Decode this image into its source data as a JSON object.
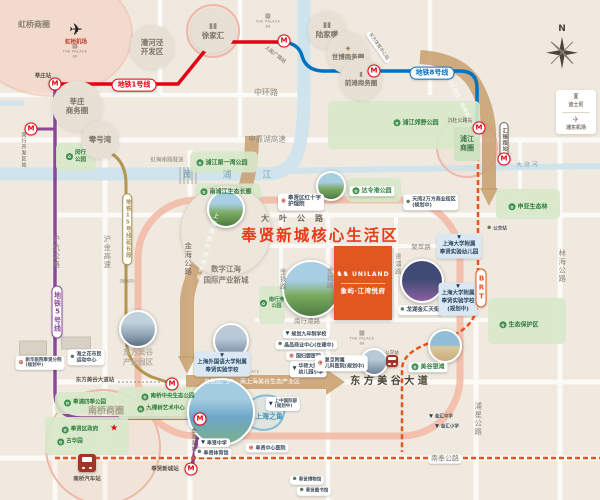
{
  "title": "奉贤新城核心生活区",
  "colors": {
    "background": "#efe9df",
    "road": "#fcfaf7",
    "river": "#cfe4ec",
    "line1_red": "#e60012",
    "line5_purple": "#8c4799",
    "line8_blue": "#0073c0",
    "line15_tan": "#b3954f",
    "brt_orange": "#e8541e",
    "title_red": "#e83a17",
    "band_tan": "#c89f6e",
    "salmon_ring": "#f2b8a3",
    "park_green": "#d7e8c9",
    "brand_orange": "#e2571f"
  },
  "items": [
    {
      "n": "park-area-minhang-park",
      "t": "blob",
      "x": 76,
      "y": 157,
      "w": 40,
      "h": 28
    },
    {
      "n": "park-area-first-bay",
      "t": "blob",
      "x": 224,
      "y": 162,
      "w": 68,
      "h": 21
    },
    {
      "n": "park-area-nanpujiang",
      "t": "blob",
      "x": 228,
      "y": 192,
      "w": 66,
      "h": 17
    },
    {
      "n": "park-area-dalinggang",
      "t": "blob",
      "x": 374,
      "y": 190,
      "w": 54,
      "h": 24
    },
    {
      "n": "park-area-shenya",
      "t": "blob",
      "x": 528,
      "y": 204,
      "w": 64,
      "h": 30
    },
    {
      "n": "park-area-baohuqu",
      "t": "blob",
      "x": 527,
      "y": 321,
      "w": 78,
      "h": 46
    },
    {
      "n": "park-area-jiaoye",
      "t": "blob",
      "x": 404,
      "y": 125,
      "w": 152,
      "h": 48
    },
    {
      "n": "park-area-siji",
      "t": "blob",
      "x": 86,
      "y": 403,
      "w": 62,
      "h": 22
    },
    {
      "n": "park-area-central",
      "t": "blob",
      "x": 169,
      "y": 403,
      "w": 102,
      "h": 32
    },
    {
      "n": "park-area-guhua",
      "t": "blob",
      "x": 87,
      "y": 436,
      "w": 84,
      "h": 38
    },
    {
      "n": "park-area-nanxinggang",
      "t": "blob",
      "x": 272,
      "y": 305,
      "w": 26,
      "h": 38
    },
    {
      "n": "building-xinhua",
      "t": "bld",
      "x": 33,
      "y": 348,
      "w": 26,
      "h": 13
    },
    {
      "n": "building-haizhihua",
      "t": "bld",
      "x": 76,
      "y": 343,
      "w": 28,
      "h": 11
    },
    {
      "n": "zone-caohejing",
      "t": "zone",
      "x": 152,
      "y": 47,
      "R": 22,
      "L": [
        "漕河泾",
        "开发区"
      ]
    },
    {
      "n": "zone-xujiahui",
      "t": "zone",
      "x": 213,
      "y": 31,
      "R": 22,
      "L": [
        "徐家汇"
      ],
      "ic": "towers"
    },
    {
      "n": "zone-lujiazui",
      "t": "zone",
      "x": 327,
      "y": 30,
      "R": 19,
      "L": [
        "陆家嘴"
      ],
      "ic": "towers"
    },
    {
      "n": "zone-shibo",
      "t": "zone",
      "x": 348,
      "y": 53,
      "R": 21,
      "L": [
        "世博商务圈"
      ],
      "ic": "art",
      "f": 6.5
    },
    {
      "n": "zone-qiantan",
      "t": "zone",
      "x": 361,
      "y": 79,
      "R": 21,
      "L": [
        "前滩商务圈"
      ],
      "ic": "tower",
      "f": 6.5
    },
    {
      "n": "zone-xinzhuang-biz",
      "t": "zone",
      "x": 77,
      "y": 106,
      "R": 25,
      "L": [
        "莘庄",
        "商务圈"
      ]
    },
    {
      "n": "zone-linggang-wan",
      "t": "zone",
      "x": 100,
      "y": 140,
      "R": 19,
      "L": [
        "零号湾"
      ]
    },
    {
      "n": "zone-shuzi-jianghai",
      "t": "zone",
      "x": 226,
      "y": 231,
      "R": 45,
      "L": [],
      "big": 1
    },
    {
      "n": "zone-pujiang-biz",
      "t": "gbox",
      "x": 467,
      "y": 144,
      "w": 26,
      "h": 34,
      "L": [
        "浦江",
        "商圈"
      ]
    },
    {
      "n": "photo-shuzi-jianghai",
      "t": "photo",
      "x": 226,
      "y": 209,
      "R": 17,
      "g": "park"
    },
    {
      "n": "photo-dalinggang",
      "t": "photo",
      "x": 331,
      "y": 186,
      "R": 13,
      "g": "park"
    },
    {
      "n": "photo-dfmg-park",
      "t": "photo",
      "x": 138,
      "y": 329,
      "R": 17,
      "g": "city"
    },
    {
      "n": "photo-shangwai-school",
      "t": "photo",
      "x": 231,
      "y": 341,
      "R": 16,
      "g": "bld"
    },
    {
      "n": "photo-shanghai-fish",
      "t": "photo",
      "x": 221,
      "y": 412,
      "R": 32,
      "g": "fish"
    },
    {
      "n": "photo-longhu",
      "t": "photo",
      "x": 422,
      "y": 281,
      "R": 20,
      "g": "mall"
    },
    {
      "n": "photo-fudan-hospital",
      "t": "photo",
      "x": 374,
      "y": 362,
      "R": 12,
      "g": "bld"
    },
    {
      "n": "photo-meigu-beach",
      "t": "photo",
      "x": 445,
      "y": 346,
      "R": 15,
      "g": "beach"
    },
    {
      "n": "photo-nanxinggang-park",
      "t": "photo",
      "x": 311,
      "y": 289,
      "R": 27,
      "g": "park"
    },
    {
      "n": "brand-block-uniland",
      "t": "brand",
      "x": 363,
      "y": 283,
      "L": [
        "UNILAND",
        "象屿·江湾悦府"
      ]
    },
    {
      "n": "palace-logo-hongqiao",
      "t": "palace",
      "x": 75,
      "y": 51,
      "L": [
        "THE PALACE",
        "88"
      ]
    },
    {
      "n": "palace-logo-renmin",
      "t": "palace",
      "x": 268,
      "y": 21,
      "L": [
        "THE PALACE",
        "88"
      ]
    },
    {
      "n": "palace-logo-shangwai",
      "t": "palace",
      "x": 247,
      "y": 371,
      "L": [
        "THE PALACE",
        "88"
      ]
    },
    {
      "n": "palace-logo-jinhui",
      "t": "palace",
      "x": 362,
      "y": 338,
      "L": [
        "THE PALACE",
        "88"
      ]
    },
    {
      "n": "disney-airport-box",
      "t": "disney",
      "x": 576,
      "y": 112,
      "L": [
        "迪士尼",
        "浦东机场"
      ]
    },
    {
      "n": "compass",
      "t": "compass",
      "x": 562,
      "y": 49,
      "s": "N"
    },
    {
      "n": "bus-nanqiao-station",
      "t": "bus",
      "x": 87,
      "y": 463,
      "S": 18
    },
    {
      "n": "bus-stop-jinhui",
      "t": "bus",
      "x": 392,
      "y": 343,
      "S": 12
    },
    {
      "n": "band-left-label",
      "t": "t",
      "x": 206,
      "y": 247,
      "s": "上海南部科技创新带",
      "f": 6,
      "v": 1,
      "r": 15,
      "c": "#fff",
      "ls": 2
    },
    {
      "n": "band-right-label",
      "t": "t",
      "x": 460,
      "y": 103,
      "s": "浦东滨江岸线、连接新老产业带",
      "f": 5.5,
      "r": 63,
      "c": "#fff"
    },
    {
      "n": "band-bottom-label",
      "t": "t",
      "x": 252,
      "y": 382,
      "s": "自贸区门户、南上海美谷生态产业区",
      "f": 6,
      "c": "#fff"
    },
    {
      "n": "road-zhonghuan",
      "t": "t",
      "x": 266,
      "y": 93,
      "s": "中环路",
      "f": 8
    },
    {
      "n": "road-shenjiahu",
      "t": "t",
      "x": 267,
      "y": 139,
      "s": "申嘉湖高速",
      "f": 7.5
    },
    {
      "n": "road-daye",
      "t": "t",
      "x": 297,
      "y": 219,
      "s": "大叶公路",
      "f": 8,
      "ls": 10,
      "c": "#6f6758",
      "b": 1
    },
    {
      "n": "road-huhang",
      "t": "t",
      "x": 56,
      "y": 252,
      "s": "沪杭公路",
      "f": 7.5,
      "v": 1
    },
    {
      "n": "road-hujin",
      "t": "t",
      "x": 107,
      "y": 252,
      "s": "沪金高速",
      "f": 7.5,
      "v": 1
    },
    {
      "n": "road-jinhai",
      "t": "t",
      "x": 188,
      "y": 259,
      "s": "金海公路",
      "f": 7.5,
      "v": 1,
      "c": "#6f6758"
    },
    {
      "n": "road-jinqian",
      "t": "t",
      "x": 282,
      "y": 279,
      "s": "金钱路",
      "f": 6.5,
      "v": 1
    },
    {
      "n": "road-jinbi",
      "t": "t",
      "x": 329,
      "y": 278,
      "s": "金碧路",
      "f": 6.5,
      "v": 1
    },
    {
      "n": "road-xianpu",
      "t": "t",
      "x": 397,
      "y": 264,
      "s": "贤浦路",
      "f": 6.5,
      "v": 1
    },
    {
      "n": "road-jucui",
      "t": "t",
      "x": 421,
      "y": 247,
      "s": "聚萃路",
      "f": 6.5
    },
    {
      "n": "road-nanxinggang",
      "t": "t",
      "x": 307,
      "y": 321,
      "s": "南行港路",
      "f": 6.5
    },
    {
      "n": "road-linhai",
      "t": "t",
      "x": 562,
      "y": 266,
      "s": "林海公路",
      "f": 7.5,
      "v": 1
    },
    {
      "n": "road-puxing",
      "t": "t",
      "x": 478,
      "y": 419,
      "s": "浦星公路",
      "f": 7.5,
      "v": 1
    },
    {
      "n": "road-dongfang-meigu-dadao",
      "t": "t",
      "x": 389,
      "y": 382,
      "s": "东 方 美 谷 大 道",
      "f": 10,
      "b": 1,
      "c": "#4a4336"
    },
    {
      "n": "road-nanfeng",
      "t": "t",
      "x": 445,
      "y": 459,
      "s": "南奉公路",
      "f": 7,
      "c": "#7d7567",
      "bg": "#fff"
    },
    {
      "n": "tunnel-hongmei",
      "t": "t",
      "x": 167,
      "y": 161,
      "s": "虹梅南路隧道",
      "f": 5.5
    },
    {
      "n": "river-huangpu-label",
      "t": "t",
      "x": 234,
      "y": 176,
      "s": "黄 浦 江",
      "f": 9,
      "ls": 14,
      "c": "#7fa3b5"
    },
    {
      "n": "river-dazhi-label",
      "t": "t",
      "x": 527,
      "y": 165,
      "s": "大 治 河",
      "f": 6,
      "c": "#7fa3b5"
    },
    {
      "n": "main-title",
      "t": "t",
      "x": 320,
      "y": 236,
      "s": "奉贤新城核心生活区",
      "f": 15.5,
      "b": 1,
      "ls": 2,
      "c": "#e83a17"
    },
    {
      "n": "hongqiao-biz-label",
      "t": "t",
      "x": 34,
      "y": 25,
      "s": "虹桥商圈",
      "f": 8,
      "b": 1,
      "c": "#8a8173"
    },
    {
      "n": "hongqiao-plane-icon",
      "t": "t",
      "x": 76,
      "y": 30,
      "s": "✈",
      "f": 16,
      "c": "#1c1c1c"
    },
    {
      "n": "hongqiao-airport-label",
      "t": "t",
      "x": 76,
      "y": 43,
      "s": "虹桥机场",
      "f": 5.5,
      "c": "#c0392b",
      "b": 1
    },
    {
      "n": "shuzi-jianghai-line1",
      "t": "t",
      "x": 226,
      "y": 269,
      "s": "数字江海",
      "f": 7.5,
      "c": "#8a8173",
      "b": 1
    },
    {
      "n": "shuzi-jianghai-line2",
      "t": "t",
      "x": 226,
      "y": 280,
      "s": "国际产业新城",
      "f": 7.5,
      "c": "#8a8173",
      "b": 1
    },
    {
      "n": "dfmg-park-line1",
      "t": "t",
      "x": 138,
      "y": 352,
      "s": "东方美谷",
      "f": 7.5,
      "c": "#b7af9f",
      "b": 1
    },
    {
      "n": "dfmg-park-line2",
      "t": "t",
      "x": 138,
      "y": 362,
      "s": "产业园区",
      "f": 7.5,
      "c": "#b7af9f",
      "b": 1
    },
    {
      "n": "nanqiao-biz-label",
      "t": "t",
      "x": 106,
      "y": 412,
      "s": "南桥商圈",
      "f": 9,
      "c": "#a89f8e",
      "b": 1
    },
    {
      "n": "fish-label",
      "t": "t",
      "x": 269,
      "y": 417,
      "s": "上海之鱼",
      "f": 7,
      "c": "#3a95bd",
      "b": 1
    },
    {
      "n": "gov-star-icon",
      "t": "t",
      "x": 114,
      "y": 429,
      "s": "★",
      "f": 9,
      "c": "#e60012"
    },
    {
      "n": "gt-minhang-park",
      "t": "gt",
      "x": 76,
      "y": 157,
      "L": [
        "闵行",
        "公园"
      ],
      "f": 5.5
    },
    {
      "n": "gt-first-bay-park",
      "t": "gt",
      "x": 222,
      "y": 163,
      "s": "浦江第一湾公园"
    },
    {
      "n": "gt-nanpujiang-corridor",
      "t": "gt",
      "x": 226,
      "y": 192,
      "s": "南浦江生态长廊"
    },
    {
      "n": "gt-dalinggang-park",
      "t": "gt",
      "x": 372,
      "y": 191,
      "s": "达令港公园",
      "wbg": 1
    },
    {
      "n": "gt-shenya-forest",
      "t": "gt",
      "x": 528,
      "y": 207,
      "s": "申亚生态林"
    },
    {
      "n": "gt-eco-reserve",
      "t": "gt",
      "x": 519,
      "y": 325,
      "s": "生态保护区"
    },
    {
      "n": "gt-pujiang-country-park",
      "t": "gt",
      "x": 416,
      "y": 123,
      "s": "浦江郊野公园"
    },
    {
      "n": "gt-fengpu-siji-park",
      "t": "gt",
      "x": 85,
      "y": 403,
      "s": "奉浦四季公园",
      "f": 5.5
    },
    {
      "n": "gt-nanqiao-central-park",
      "t": "gt",
      "x": 168,
      "y": 397,
      "s": "南桥中央生态公园",
      "f": 5.5
    },
    {
      "n": "gt-jiukeshu-art",
      "t": "gt",
      "x": 161,
      "y": 409,
      "s": "九棵树艺术中心",
      "f": 5.5
    },
    {
      "n": "gt-fengxian-gov",
      "t": "gt",
      "x": 80,
      "y": 430,
      "s": "奉贤区政府",
      "f": 5.5
    },
    {
      "n": "gt-guhuayuan",
      "t": "gt",
      "x": 70,
      "y": 442,
      "s": "古华园",
      "f": 5.5
    },
    {
      "n": "gt-nanxinggang-park",
      "t": "gt",
      "x": 272,
      "y": 303,
      "L": [
        "南行港",
        "公园"
      ],
      "f": 5
    },
    {
      "n": "gt-meigu-beach",
      "t": "gt",
      "x": 428,
      "y": 367,
      "s": "美谷银滩",
      "wbg": 1
    },
    {
      "n": "wt-redcross-hospital",
      "t": "wt",
      "x": 301,
      "y": 202,
      "L": [
        "奉贤区红十字",
        "护理院"
      ],
      "ic": "hosp"
    },
    {
      "n": "wt-tianyue-mall",
      "t": "wt",
      "x": 431,
      "y": 202,
      "L": [
        "天阅2万方商业街区",
        "(规划中)"
      ],
      "ic": "dot",
      "f": 5
    },
    {
      "n": "wt-planned-school",
      "t": "wt",
      "x": 306,
      "y": 334,
      "s": "规划九年制学校",
      "ic": "school",
      "f": 5
    },
    {
      "n": "wt-jingpin-mall",
      "t": "wt",
      "x": 306,
      "y": 345,
      "s": "晶品商业中心(在建中)",
      "ic": "dot",
      "f": 5
    },
    {
      "n": "wt-guofuying-hospital",
      "t": "wt",
      "x": 305,
      "y": 356,
      "s": "国妇婴医院",
      "ic": "hosp",
      "f": 5
    },
    {
      "n": "wt-huashida-school",
      "t": "wt",
      "x": 308,
      "y": 369,
      "L": [
        "华师大附属",
        "幼儿园小学"
      ],
      "ic": "school",
      "f": 5
    },
    {
      "n": "wt-fudan-children-hospital",
      "t": "wt",
      "x": 341,
      "y": 363,
      "L": [
        "复旦附属",
        "儿科医院(规划中)"
      ],
      "ic": "hosp",
      "f": 5
    },
    {
      "n": "wt-longhu-tianjie",
      "t": "wt",
      "x": 420,
      "y": 310,
      "s": "龙湖金汇天街",
      "ic": "dot"
    },
    {
      "n": "wt-haizhihua-sports",
      "t": "wt",
      "x": 86,
      "y": 357,
      "L": [
        "海之花市民",
        "运动中心"
      ],
      "ic": "dot",
      "f": 5
    },
    {
      "n": "wt-xinhua-hospital",
      "t": "wt",
      "x": 40,
      "y": 363,
      "L": [
        "新华医院奉贤分院",
        "(规划中)"
      ],
      "ic": "hosp",
      "f": 4.5
    },
    {
      "n": "wt-fengxian-hs",
      "t": "wt",
      "x": 214,
      "y": 443,
      "s": "奉贤中学",
      "ic": "school",
      "f": 5
    },
    {
      "n": "wt-fengxian-gym",
      "t": "wt",
      "x": 213,
      "y": 453,
      "s": "奉贤体育馆",
      "ic": "dot",
      "f": 5
    },
    {
      "n": "wt-fengxian-hospital",
      "t": "wt",
      "x": 267,
      "y": 448,
      "s": "奉贤中心医院",
      "ic": "hosp",
      "f": 5
    },
    {
      "n": "wt-shangzhong-intl",
      "t": "wt",
      "x": 283,
      "y": 404,
      "L": [
        "上中国际部",
        "(规划中)"
      ],
      "ic": "school",
      "f": 4.5
    },
    {
      "n": "wt-jinhui-middle-school",
      "t": "wt",
      "x": 441,
      "y": 417,
      "s": "金汇中学",
      "ic": "school",
      "f": 4.5,
      "plain": 1
    },
    {
      "n": "wt-jinhui-primary-school",
      "t": "wt",
      "x": 447,
      "y": 427,
      "s": "金汇小学",
      "ic": "school",
      "f": 4.5,
      "plain": 1
    },
    {
      "n": "wt-fengxian-museum",
      "t": "wt",
      "x": 307,
      "y": 480,
      "s": "奉贤博物馆",
      "ic": "dot",
      "f": 4.5
    },
    {
      "n": "wt-fengxian-library",
      "t": "wt",
      "x": 314,
      "y": 491,
      "s": "奉贤图书馆",
      "ic": "dot",
      "f": 4.5
    },
    {
      "n": "wt-bus-stop-right",
      "t": "wt",
      "x": 497,
      "y": 229,
      "s": "公交站",
      "ic": "dot",
      "f": 4.5,
      "plain": 1
    },
    {
      "n": "bus-stop-jinhui-label",
      "t": "t",
      "x": 392,
      "y": 354,
      "s": "公交站",
      "f": 4.5,
      "c": "#5f574a"
    },
    {
      "n": "bus-nanqiao-label",
      "t": "t",
      "x": 87,
      "y": 480,
      "s": "南桥汽车站",
      "f": 5.5,
      "c": "#5f574a",
      "b": 1
    },
    {
      "n": "bt-shangwai-school",
      "t": "bt",
      "x": 222,
      "y": 364,
      "L": [
        "上海外国语大学附属",
        "奉贤实验学校"
      ]
    },
    {
      "n": "bt-shangda-kindergarten",
      "t": "bt",
      "x": 459,
      "y": 246,
      "L": [
        "上海大学附属",
        "奉贤实验幼儿园"
      ]
    },
    {
      "n": "bt-shangda-school",
      "t": "bt",
      "x": 458,
      "y": 299,
      "L": [
        "上海大学附属",
        "奉贤实验学校",
        "(规划中)"
      ]
    },
    {
      "n": "line1-pill",
      "t": "pill",
      "x": 134,
      "y": 85,
      "s": "地铁1号线",
      "c": "#e60012"
    },
    {
      "n": "line8-pill",
      "t": "pill",
      "x": 432,
      "y": 73,
      "s": "地铁8号线",
      "c": "#0073c0"
    },
    {
      "n": "line5-pill",
      "t": "pill",
      "x": 57,
      "y": 312,
      "s": "地铁5号线",
      "c": "#8c4799",
      "v": 1
    },
    {
      "n": "line15-pill",
      "t": "pill",
      "x": 127,
      "y": 229,
      "s": "地铁15号线延长段",
      "c": "#a8904e",
      "v": 1,
      "f": 5.5
    },
    {
      "n": "line15-planned-label",
      "t": "t",
      "x": 127,
      "y": 281,
      "s": "(规划中)",
      "f": 4,
      "c": "#8f8779"
    },
    {
      "n": "brt-pill",
      "t": "pill",
      "x": 481,
      "y": 288,
      "s": "BRT",
      "c": "#e8541e",
      "v": 1,
      "f": 7
    },
    {
      "n": "huizhenlu-station-pill",
      "t": "pill",
      "x": 504,
      "y": 140,
      "s": "汇臻路站",
      "c": "#6f6758",
      "v": 1,
      "f": 5
    },
    {
      "n": "station-xinzhuang",
      "t": "m",
      "x": 55,
      "y": 84
    },
    {
      "n": "station-xinzhuang-label",
      "t": "t",
      "x": 43,
      "y": 77,
      "s": "莘庄站",
      "f": 5.5,
      "c": "#5f574a",
      "b": 1
    },
    {
      "n": "station-minhang-kaifaqu",
      "t": "m",
      "x": 31,
      "y": 129
    },
    {
      "n": "station-minhang-label",
      "t": "t",
      "x": 23,
      "y": 150,
      "s": "闵行开发区站",
      "f": 5,
      "v": 1,
      "c": "#5f574a"
    },
    {
      "n": "station-renmin-guangchang",
      "t": "m",
      "x": 284,
      "y": 41
    },
    {
      "n": "station-renmin-label",
      "t": "t",
      "x": 275,
      "y": 55,
      "s": "人民广场站",
      "f": 5,
      "r": 38,
      "c": "#5f574a"
    },
    {
      "n": "station-dongfang-tiyu",
      "t": "m",
      "x": 374,
      "y": 71
    },
    {
      "n": "station-dongfang-tiyu-label",
      "t": "t",
      "x": 378,
      "y": 47,
      "s": "东方体育中心站",
      "f": 4.5,
      "r": 55,
      "c": "#5f574a",
      "bg": "#fff"
    },
    {
      "n": "station-chendu-gonglu",
      "t": "m",
      "x": 479,
      "y": 128
    },
    {
      "n": "station-chendu-label",
      "t": "t",
      "x": 460,
      "y": 121,
      "s": "沉杜公路站",
      "f": 5,
      "c": "#5f574a"
    },
    {
      "n": "station-huizhenlu",
      "t": "m",
      "x": 504,
      "y": 159
    },
    {
      "n": "station-jinhaihu",
      "t": "m",
      "x": 200,
      "y": 419
    },
    {
      "n": "station-jinhaihu-label",
      "t": "t",
      "x": 193,
      "y": 440,
      "s": "金海湖站",
      "f": 5,
      "v": 1,
      "c": "#5f574a"
    },
    {
      "n": "station-fengxian-xincheng",
      "t": "m",
      "x": 191,
      "y": 469
    },
    {
      "n": "station-fengxian-xincheng-label",
      "t": "t",
      "x": 165,
      "y": 470,
      "s": "奉贤新城站",
      "f": 5.5,
      "c": "#5f574a",
      "b": 1
    },
    {
      "n": "station-dfmg-dadao",
      "t": "m",
      "x": 172,
      "y": 384
    },
    {
      "n": "station-dfmg-dadao-label",
      "t": "t",
      "x": 95,
      "y": 381,
      "s": "东方美谷大道站",
      "f": 5.5,
      "c": "#5f574a",
      "b": 1
    }
  ]
}
